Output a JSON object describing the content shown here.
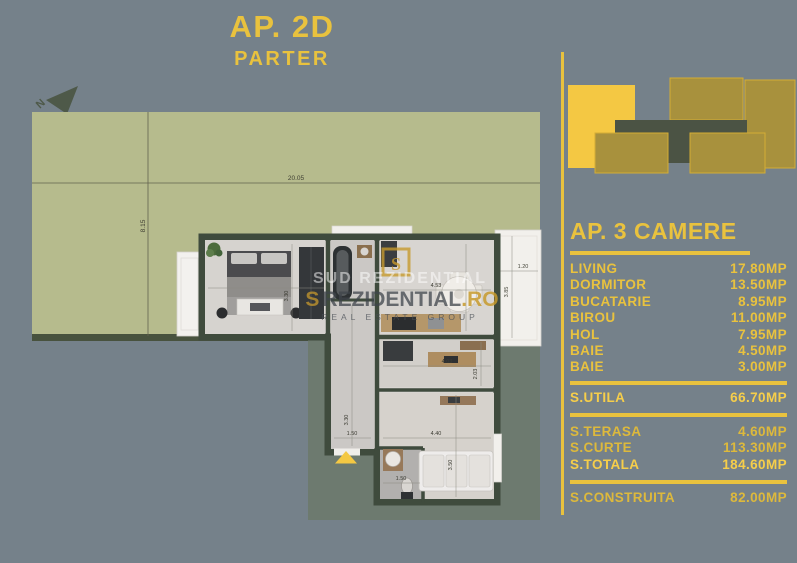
{
  "colors": {
    "background": "#75818a",
    "gold": "#e9c23e",
    "gold_bright": "#f4c843",
    "olive": "#a8913d",
    "olive_outline": "#d4ad35",
    "building_dark": "#4b5344",
    "lawn": "#b6bb8d",
    "wall": "#3f4b3d",
    "terrace_white": "#f3f1ee"
  },
  "title": {
    "apartment": "AP. 2D",
    "floor": "PARTER"
  },
  "plan": {
    "north": "N",
    "watermark": {
      "mark": "S",
      "top": "SUD REZIDENTIAL",
      "brand": "REZIDENTIAL",
      "tld": ".RO",
      "tagline": "REAL ESTATE GROUP"
    },
    "dims": {
      "lawn_w": "20.05",
      "lawn_h": "8.15",
      "bedroom_h": "3.30",
      "hall_h": "3.30",
      "kitchen_w": "4.53",
      "terrace_w": "1.20",
      "terrace_h": "3.85",
      "birou_w": "4.03",
      "birou_h": "2.03",
      "entry_w": "1.50",
      "bath_w": "1.50",
      "living_w": "4.40",
      "living_h": "3.50"
    }
  },
  "panel": {
    "heading": "AP. 3 CAMERE",
    "rooms": [
      {
        "label": "LIVING",
        "value": "17.80MP"
      },
      {
        "label": "DORMITOR",
        "value": "13.50MP"
      },
      {
        "label": "BUCATARIE",
        "value": "8.95MP"
      },
      {
        "label": "BIROU",
        "value": "11.00MP"
      },
      {
        "label": "HOL",
        "value": "7.95MP"
      },
      {
        "label": "BAIE",
        "value": "4.50MP"
      },
      {
        "label": "BAIE",
        "value": "3.00MP"
      }
    ],
    "utila": {
      "label": "S.UTILA",
      "value": "66.70MP"
    },
    "outdoor": [
      {
        "label": "S.TERASA",
        "value": "4.60MP"
      },
      {
        "label": "S.CURTE",
        "value": "113.30MP"
      },
      {
        "label": "S.TOTALA",
        "value": "184.60MP"
      }
    ],
    "construita": {
      "label": "S.CONSTRUITA",
      "value": "82.00MP"
    }
  }
}
